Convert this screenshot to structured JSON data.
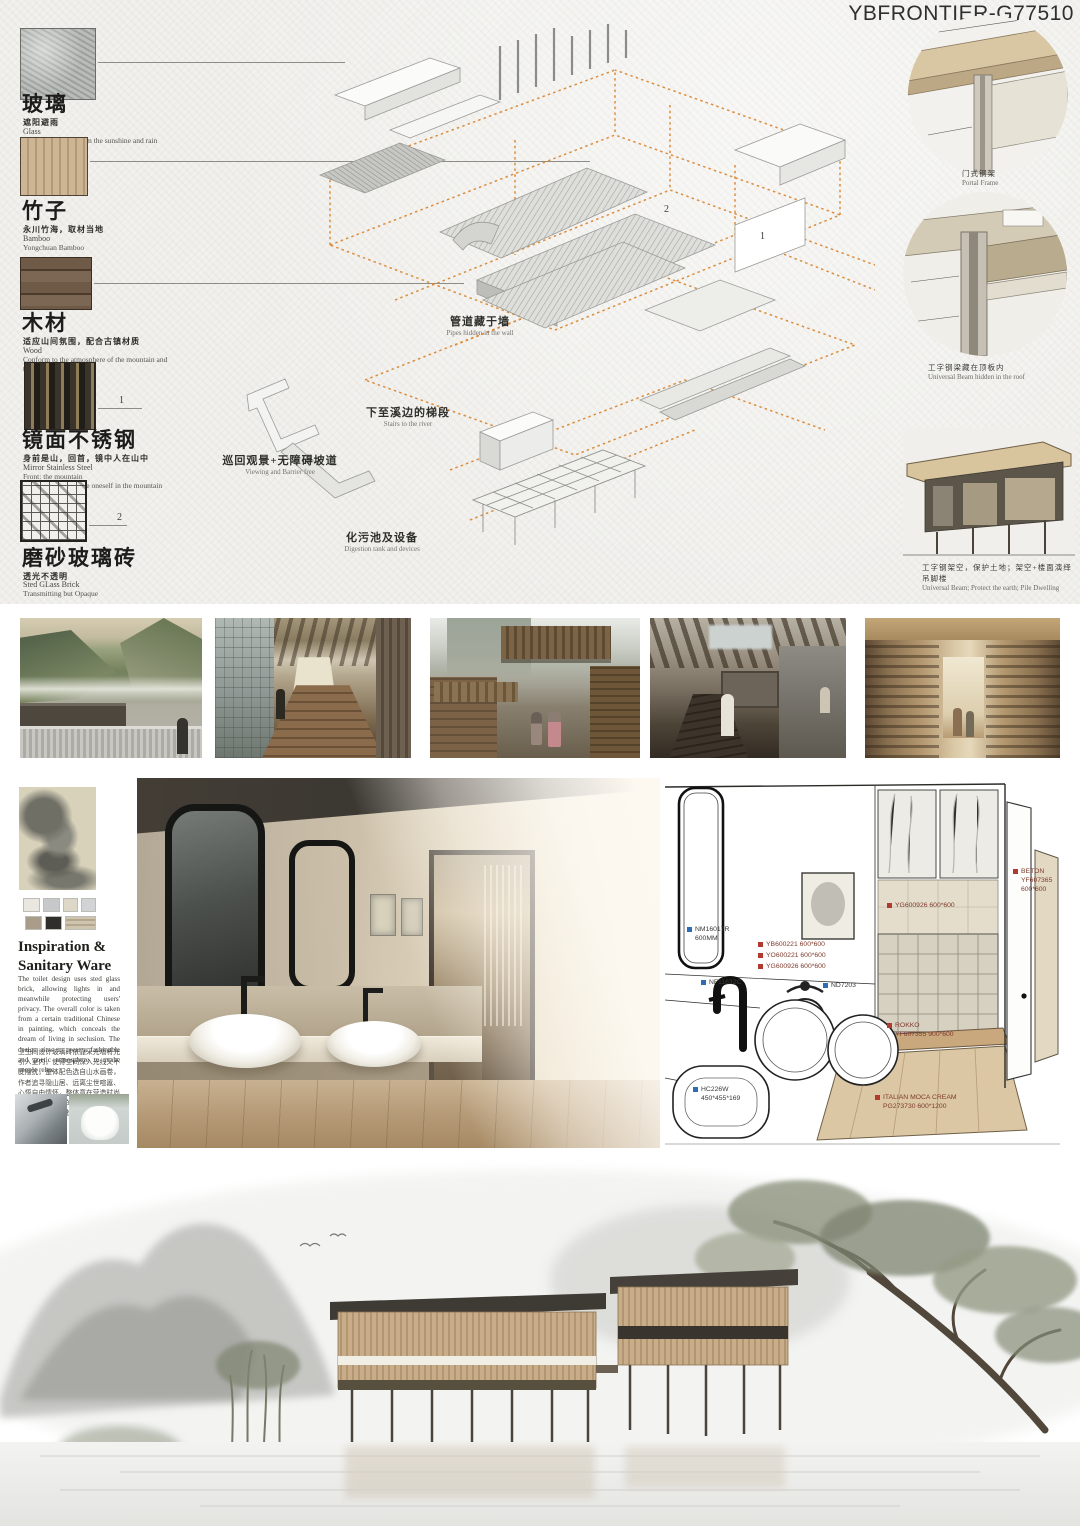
{
  "header": {
    "title": "YBFRONTIER-G77510"
  },
  "colors": {
    "accent_orange": "#d9822b",
    "marker_red": "#b03a2e",
    "marker_blue": "#2e6db4",
    "paper": "#efeeea"
  },
  "materials": [
    {
      "cn": "玻璃",
      "cn_sub": "遮阳避雨",
      "en_name": "Glass",
      "en_desc": "To protect people from the sunshine and rain"
    },
    {
      "cn": "竹子",
      "cn_sub": "永川竹海，取材当地",
      "en_name": "Bamboo",
      "en_desc": "Yongchuan Bamboo"
    },
    {
      "cn": "木材",
      "cn_sub": "适应山间氛围，配合古镇材质",
      "en_name": "Wood",
      "en_desc": "Conform to the atmosphere of the mountain and\nthe Songji Town"
    },
    {
      "cn": "镜面不锈钢",
      "cn_sub": "身前是山，回首，镜中人在山中",
      "en_name": "Mirror Stainless Steel",
      "en_desc": "Front: the mountain\nTurn back around: see oneself in the mountain",
      "marker": "1"
    },
    {
      "cn": "磨砂玻璃砖",
      "cn_sub": "透光不透明",
      "en_name": "Sted GLass Brick",
      "en_desc": "Transmitting but Opaque",
      "marker": "2"
    }
  ],
  "axon": {
    "annotations": [
      {
        "cn": "管道藏于墙",
        "en": "Pipes hidden in the wall"
      },
      {
        "cn": "下至溪边的梯段",
        "en": "Stairs to the river"
      },
      {
        "cn": "巡回观景+无障碍坡道",
        "en": "Viewing and Barrier free"
      },
      {
        "cn": "化污池及设备",
        "en": "Digestion tank and devices"
      }
    ],
    "markers": {
      "m1": "1",
      "m2": "2"
    }
  },
  "details": [
    {
      "cn": "门式钢架",
      "en": "Portal Frame"
    },
    {
      "cn": "工字钢梁藏在顶板内",
      "en": "Universal Beam hidden in the roof"
    },
    {
      "cn": "工字钢架空，保护土地；架空+楼面演绎吊脚楼",
      "en": "Universal Beam; Protect the earth; Pile Dwelling"
    }
  ],
  "sanitary": {
    "heading": "Inspiration &\nSanitary Ware",
    "en_paragraph": "The toilet design uses sted glass brick, allowing lights in and meanwhile protecting users' privacy. The overall color is taken from a certain traditional Chinese in painting, which conceals the dream of living in seclusion. The design aims to creat a fashinable and poetic atmosphere to make people relax.",
    "cn_paragraph": "卫生间设计玻璃砖依靠采光墙将光引入室内，使得空间深入光线又不受阻扰，整体配色选自山水画卷，作者追寻隐山居、远离尘世喧嚣、心悟自由情怀，整体意在营造时尚而又有文化内涵的诗意氛围，使人们的心情得到放松。"
  },
  "diagram": {
    "labels": [
      {
        "text": "NM16017R\n600MM",
        "color": "blue"
      },
      {
        "text": "YB600221 600*600",
        "color": "red"
      },
      {
        "text": "YO600221 600*600",
        "color": "red"
      },
      {
        "text": "YG600926 600*600",
        "color": "red"
      },
      {
        "text": "NF11632C",
        "color": "blue"
      },
      {
        "text": "ND7203",
        "color": "blue"
      },
      {
        "text": "BETON\nYF607365\n600*600",
        "color": "red"
      },
      {
        "text": "YG600926 600*600",
        "color": "red"
      },
      {
        "text": "ROKKO\nYF607355 900*600",
        "color": "red"
      },
      {
        "text": "HC226W\n450*455*169",
        "color": "blue"
      },
      {
        "text": "ITALIAN MOCA CREAM\nPG273730 600*1200",
        "color": "red"
      }
    ]
  }
}
